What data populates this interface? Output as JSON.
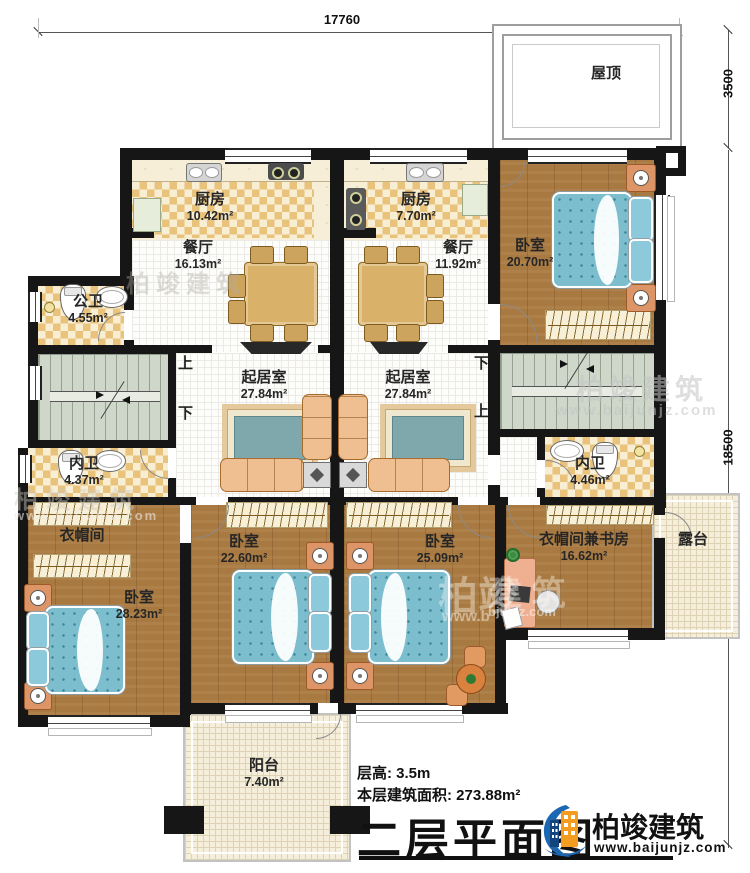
{
  "dimensions": {
    "top": "17760",
    "roof_right": "3500",
    "main_right": "18500"
  },
  "rooms": {
    "roof": {
      "name": "屋顶"
    },
    "kitchen_left": {
      "name": "厨房",
      "area": "10.42m²"
    },
    "kitchen_right": {
      "name": "厨房",
      "area": "7.70m²"
    },
    "dining_left": {
      "name": "餐厅",
      "area": "16.13m²"
    },
    "dining_right": {
      "name": "餐厅",
      "area": "11.92m²"
    },
    "bedroom_top_right": {
      "name": "卧室",
      "area": "20.70m²"
    },
    "public_bathroom": {
      "name": "公卫",
      "area": "4.55m²"
    },
    "living_left": {
      "name": "起居室",
      "area": "27.84m²"
    },
    "living_right": {
      "name": "起居室",
      "area": "27.84m²"
    },
    "bathroom_left": {
      "name": "内卫",
      "area": "4.37m²"
    },
    "bathroom_right": {
      "name": "内卫",
      "area": "4.46m²"
    },
    "cloakroom": {
      "name": "衣帽间"
    },
    "bedroom_bottom_left": {
      "name": "卧室",
      "area": "28.23m²"
    },
    "bedroom_bottom_mid_left": {
      "name": "卧室",
      "area": "22.60m²"
    },
    "bedroom_bottom_mid_right": {
      "name": "卧室",
      "area": "25.09m²"
    },
    "study": {
      "name": "衣帽间兼书房",
      "area": "16.62m²"
    },
    "terrace": {
      "name": "露台"
    },
    "balcony": {
      "name": "阳台",
      "area": "7.40m²"
    }
  },
  "stairs": {
    "left": {
      "top": "上",
      "bottom": "下"
    },
    "right": {
      "top": "下",
      "bottom": "上"
    }
  },
  "footer": {
    "floor_height": "层高: 3.5m",
    "floor_area": "本层建筑面积: 273.88m²",
    "plan_title": "二层平面图",
    "brand": "柏竣建筑",
    "website": "www.baijunjz.com"
  },
  "watermark": {
    "brand": "柏竣建筑",
    "website": "www.baijunjz.com",
    "brand_left": "柏竣",
    "brand_right": "建 筑",
    "website_left": "www.b",
    "website_right": "bjunjz.com"
  }
}
